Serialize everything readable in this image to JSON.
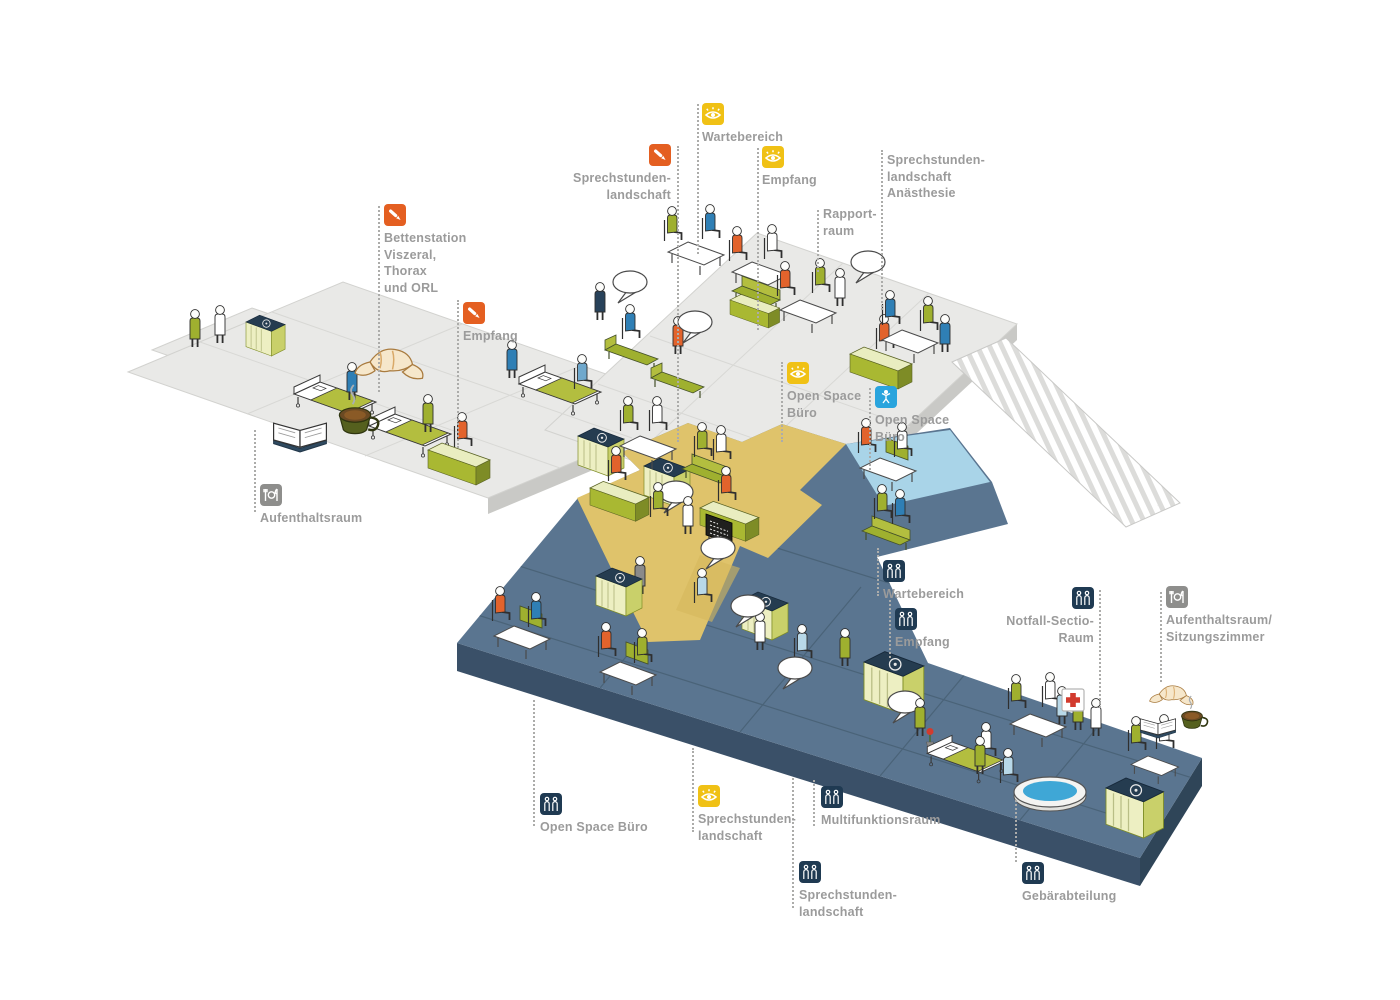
{
  "palette": {
    "floor_upper": "#E9E9E7",
    "floor_upper_side": "#C9C9C6",
    "floor_lower": "#5A7590",
    "floor_lower_side": "#3A5068",
    "zone_yellow": "#DFC36B",
    "zone_lightblue": "#A9D4E8",
    "furniture_olive": "#A9B832",
    "furniture_pale": "#EDEFC2",
    "icon_yellow": "#F0C115",
    "icon_orange": "#E45F21",
    "icon_gray": "#8E8E8C",
    "icon_navy": "#1F3A52",
    "icon_blue": "#29A4DD",
    "label_text": "#9B9B9B"
  },
  "labels": {
    "wartebereich_top": {
      "text": "Wartebereich",
      "icon": "eye-icon"
    },
    "sprechstunden_top": {
      "text": "Sprechstunden-\nlandschaft",
      "icon": "scalpel-icon"
    },
    "empfang_top": {
      "text": "Empfang",
      "icon": "eye-icon"
    },
    "anaesthesie": {
      "text": "Sprechstunden-\nlandschaft\nAnästhesie"
    },
    "rapportraum": {
      "text": "Rapport-\nraum"
    },
    "bettenstation": {
      "text": "Bettenstation\nViszeral,\nThorax\nund ORL",
      "icon": "scalpel-icon"
    },
    "empfang_gray": {
      "text": "Empfang",
      "icon": "scalpel-icon"
    },
    "openspace_yellow": {
      "text": "Open Space\nBüro",
      "icon": "eye-icon"
    },
    "openspace_blue": {
      "text": "Open Space\nBüro",
      "icon": "baby-icon"
    },
    "aufenthaltsraum_upper": {
      "text": "Aufenthaltsraum",
      "icon": "cutlery-icon"
    },
    "wartebereich_lower": {
      "text": "Wartebereich",
      "icon": "duo-icon"
    },
    "empfang_lower": {
      "text": "Empfang",
      "icon": "duo-icon"
    },
    "notfall": {
      "text": "Notfall-Sectio-\nRaum",
      "icon": "duo-icon"
    },
    "aufenthaltsraum_lower": {
      "text": "Aufenthaltsraum/\nSitzungszimmer",
      "icon": "cutlery-icon"
    },
    "openspace_lower": {
      "text": "Open Space Büro",
      "icon": "duo-icon"
    },
    "sprechstunden_mid": {
      "text": "Sprechstunden-\nlandschaft",
      "icon": "eye-icon"
    },
    "multifunktionsraum": {
      "text": "Multifunktionsraum",
      "icon": "duo-icon"
    },
    "sprechstunden_lower": {
      "text": "Sprechstunden-\nlandschaft",
      "icon": "duo-icon"
    },
    "gebaerabteilung": {
      "text": "Gebärabteilung",
      "icon": "duo-icon"
    }
  }
}
